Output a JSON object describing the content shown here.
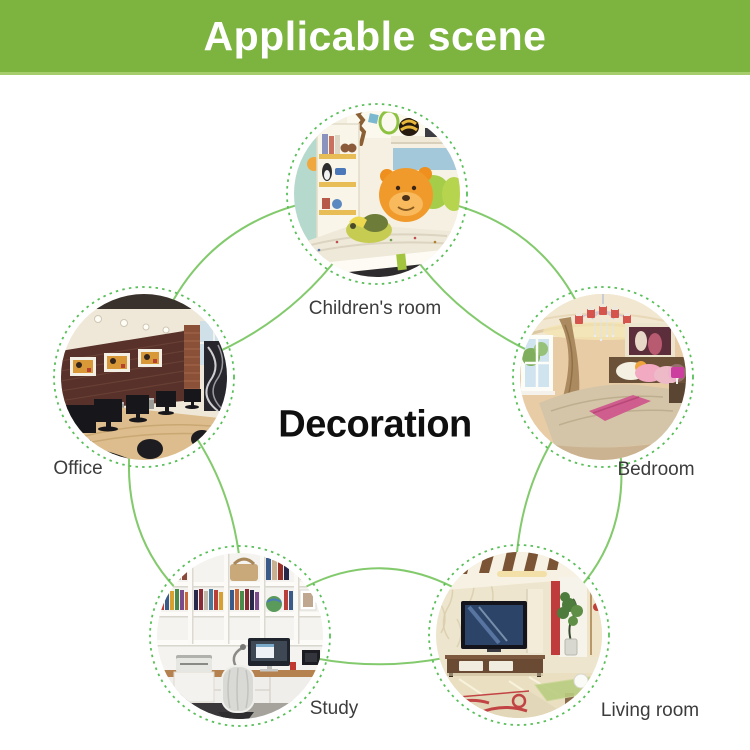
{
  "header": {
    "title": "Applicable scene"
  },
  "center": {
    "title": "Decoration"
  },
  "scenes": [
    {
      "id": "childrens-room",
      "label": "Children's room"
    },
    {
      "id": "office",
      "label": "Office"
    },
    {
      "id": "bedroom",
      "label": "Bedroom"
    },
    {
      "id": "study",
      "label": "Study"
    },
    {
      "id": "living-room",
      "label": "Living room"
    }
  ],
  "colors": {
    "banner_green": "#7db440",
    "banner_edge": "#a6cd6b",
    "banner_text": "#ffffff",
    "line_green": "#7cc765",
    "ring_green": "#58bf58",
    "label_gray": "#3c3c3c",
    "title_black": "#0f0f0f",
    "background": "#ffffff"
  }
}
